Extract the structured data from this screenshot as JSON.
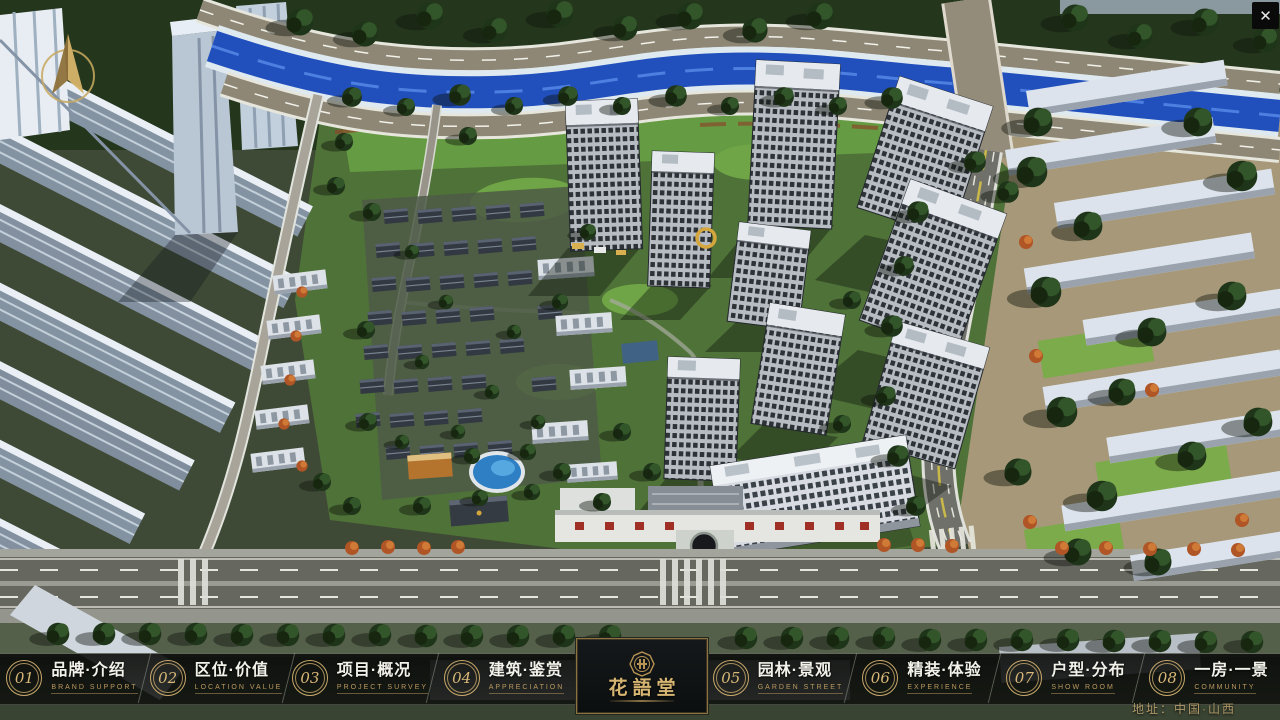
{
  "app": {
    "close_glyph": "✕"
  },
  "navbar": {
    "items": [
      {
        "number": "01",
        "label": "品牌·介绍",
        "sublabel": "BRAND SUPPORT"
      },
      {
        "number": "02",
        "label": "区位·价值",
        "sublabel": "LOCATION VALUE"
      },
      {
        "number": "03",
        "label": "项目·概况",
        "sublabel": "PROJECT SURVEY"
      },
      {
        "number": "04",
        "label": "建筑·鉴赏",
        "sublabel": "APPRECIATION"
      },
      {
        "number": "05",
        "label": "园林·景观",
        "sublabel": "GARDEN STREET"
      },
      {
        "number": "06",
        "label": "精装·体验",
        "sublabel": "EXPERIENCE"
      },
      {
        "number": "07",
        "label": "户型·分布",
        "sublabel": "SHOW ROOM"
      },
      {
        "number": "08",
        "label": "一房·一景",
        "sublabel": "COMMUNITY"
      }
    ]
  },
  "logo": {
    "title": "花語堂"
  },
  "footer": {
    "address": "地址：中国·山西"
  },
  "palette": {
    "gold": "#c9a96a",
    "nav_background": "#0c0e0c",
    "river": "#2150bd",
    "tree_dark": "#1f3519",
    "lawn": "#55793b",
    "road": "#66675f",
    "building_light": "#dde3ea"
  }
}
